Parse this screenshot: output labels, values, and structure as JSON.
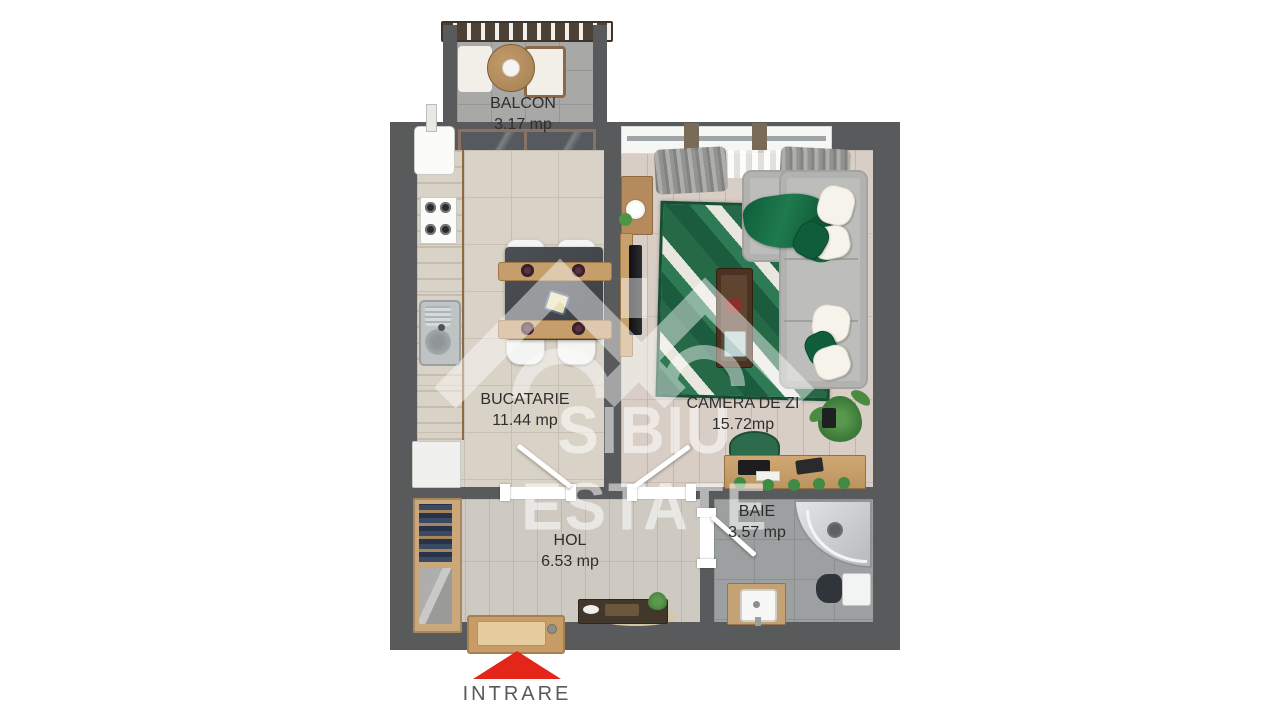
{
  "rooms": {
    "balcon": {
      "name": "BALCON",
      "area": "3.17 mp"
    },
    "bucatarie": {
      "name": "BUCATARIE",
      "area": "11.44 mp"
    },
    "camera_de_zi": {
      "name": "CAMERA DE ZI",
      "area": "15.72mp"
    },
    "hol": {
      "name": "HOL",
      "area": "6.53 mp"
    },
    "baie": {
      "name": "BAIE",
      "area": "3.57 mp"
    }
  },
  "entrance": {
    "label": "INTRARE"
  },
  "watermark": {
    "text": "SIBIU ESTATE"
  },
  "colors": {
    "wall": "#595a5c",
    "arrow_red": "#e4261a",
    "rug_green": "#1e6a46",
    "sofa_gray": "#bdbdbb",
    "wood": "#c09a6b",
    "floor_kitchen": "#d9d2c6",
    "floor_living": "#d9cec5",
    "floor_hall": "#cec9c1",
    "floor_bath": "#9da0a1",
    "floor_balcony": "#a8a8a6",
    "watermark": "#ffffff",
    "label_text": "#2e2e2e",
    "entrance_text": "#595a5c"
  }
}
